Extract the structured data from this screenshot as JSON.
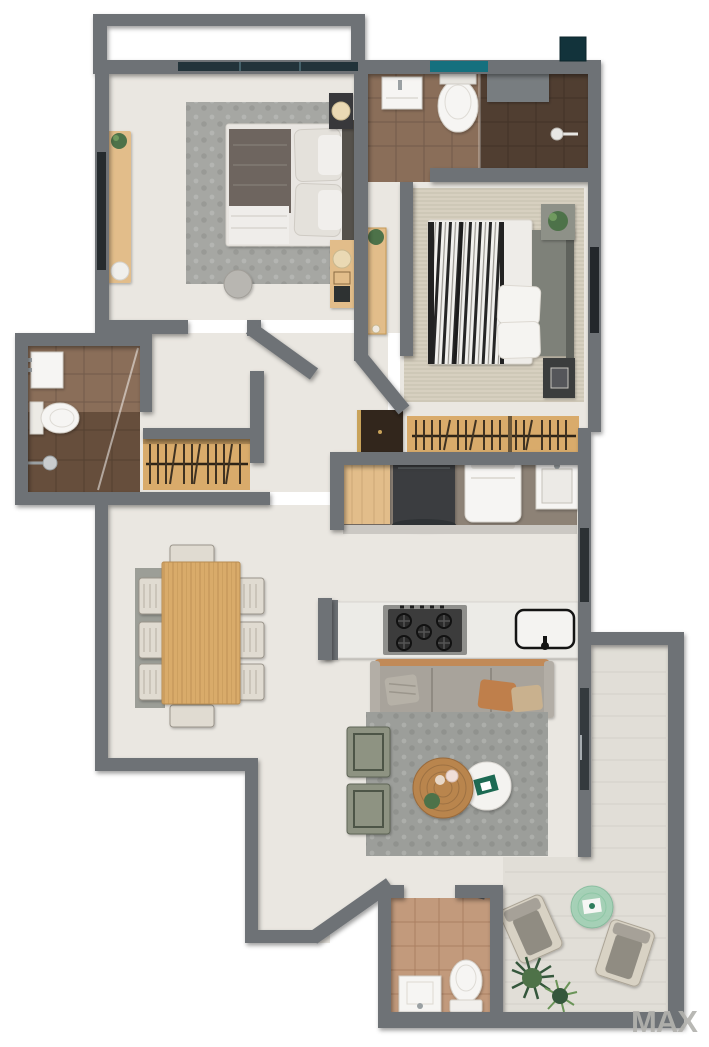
{
  "watermark": "MAX",
  "plan_type": "apartment-floor-plan-top-down-3d",
  "palette": {
    "wall": "#6e7276",
    "wallDark": "#5d6164",
    "floor": "#eae7e1",
    "terraceFloor": "#e1ded7",
    "tileBrown": "#8a6e59",
    "tileBrownDark": "#503e31",
    "tileTerracotta": "#c29a7c",
    "wood": "#d9ab6b",
    "woodLight": "#e2bd8a",
    "cabinetDark": "#32261c",
    "rugGray": "#a6a7a3",
    "rugBeige": "#d7d0c0",
    "rugLiving": "#9c9e9a",
    "duvetDark": "#6e655e",
    "duvetStripe": "#262626",
    "linen": "#efedea",
    "sofa": "#a8a39b",
    "pillowTan": "#bf7f4b",
    "greenSeat": "#8e9382",
    "plant": "#4e7248",
    "plantDark": "#35573c",
    "fixtureWhite": "#f6f5f3",
    "applianceDark": "#3b3e41",
    "hobDark": "#3c3c3c",
    "glassDark": "#22333a",
    "glassTeal": "#15707e",
    "glassGreen": "#9ed2b4",
    "headboardGray": "#7e8179",
    "watermark": "#b3b2ae"
  },
  "rooms": [
    {
      "id": "balcony-north",
      "furniture": []
    },
    {
      "id": "bedroom-1",
      "furniture": [
        "double-bed",
        "area-rug",
        "nightstand",
        "dresser",
        "table-lamp",
        "console-desk",
        "stool",
        "pouf",
        "plant"
      ]
    },
    {
      "id": "bathroom-1",
      "furniture": [
        "vanity-sink",
        "toilet",
        "walk-in-shower",
        "partition-wall"
      ]
    },
    {
      "id": "hallway",
      "furniture": [
        "console-table",
        "plant",
        "wardrobe-closet",
        "entry-cabinet"
      ]
    },
    {
      "id": "bedroom-2",
      "furniture": [
        "double-bed",
        "area-rug",
        "nightstand",
        "open-wardrobe",
        "plant"
      ]
    },
    {
      "id": "bathroom-2",
      "furniture": [
        "vanity-sink",
        "toilet",
        "shower"
      ]
    },
    {
      "id": "dining-room",
      "furniture": [
        "dining-table",
        "dining-chair-x8",
        "runner-rug"
      ]
    },
    {
      "id": "kitchen",
      "furniture": [
        "island-counter",
        "gas-hob",
        "kitchen-sink",
        "refrigerator",
        "washing-machine",
        "laundry-sink",
        "wood-counter"
      ]
    },
    {
      "id": "living-room",
      "furniture": [
        "sofa",
        "throw-pillow-x3",
        "ottoman-x2",
        "coffee-table",
        "side-table",
        "area-rug"
      ]
    },
    {
      "id": "bathroom-3",
      "furniture": [
        "vanity-sink",
        "toilet"
      ]
    },
    {
      "id": "terrace",
      "furniture": [
        "lounge-chair-x2",
        "glass-table",
        "palm-plant"
      ]
    }
  ]
}
